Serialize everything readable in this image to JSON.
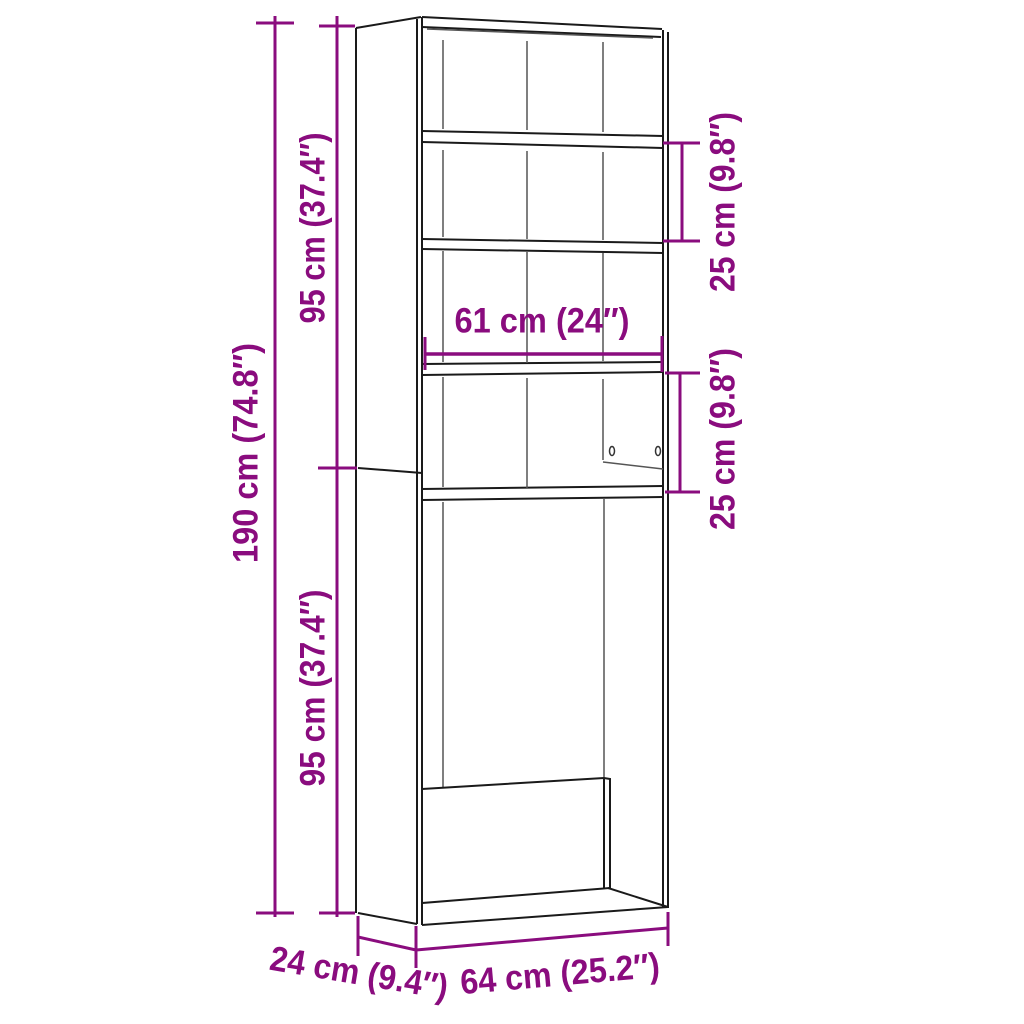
{
  "labels": {
    "total_height": "190 cm (74.8″)",
    "upper_section_height": "95 cm (37.4″)",
    "lower_section_height": "95 cm (37.4″)",
    "upper_shelf_spacing": "25 cm (9.8″)",
    "lower_shelf_spacing": "25 cm (9.8″)",
    "inner_width": "61 cm (24″)",
    "depth": "24 cm (9.4″)",
    "outer_width": "64 cm (25.2″)"
  },
  "colors": {
    "dimension-accent": "#8A0C7E",
    "outline-black": "#1A1A1A",
    "seam-gray": "#555555",
    "background": "#FFFFFF"
  }
}
